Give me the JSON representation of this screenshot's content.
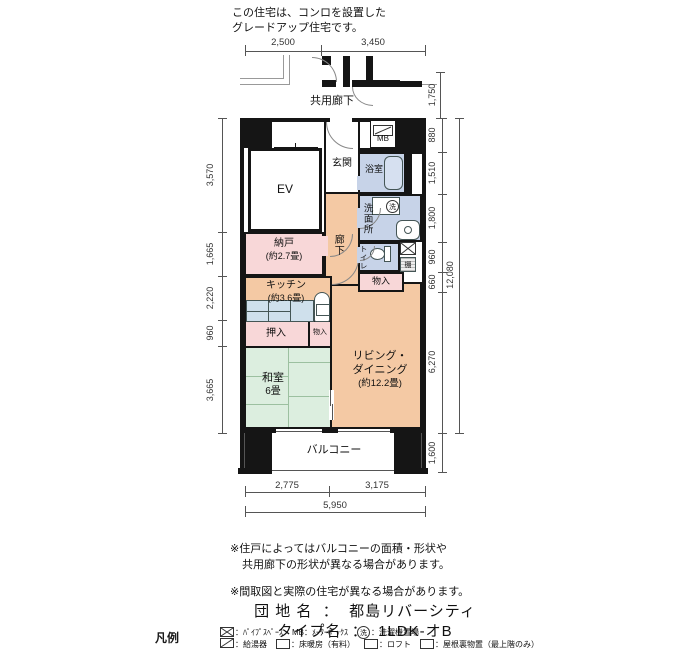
{
  "header_note": {
    "line1": "この住宅は、コンロを設置した",
    "line2": "グレードアップ住宅です。"
  },
  "plan": {
    "corridor_label": "共用廊下",
    "balcony_label": "バルコニー",
    "rooms": {
      "ev": "EV",
      "entrance": "玄関",
      "mb": "MB",
      "bath": "浴室",
      "washroom": "洗面所",
      "hallway": "廊下",
      "storage_room_name": "納戸",
      "storage_room_size": "(約2.7畳)",
      "kitchen_name": "キッチン",
      "kitchen_size": "(約3.6畳)",
      "toilet": "トイレ",
      "shelf": "棚",
      "closet_right": "物入",
      "oshiire": "押入",
      "closet_small": "物入",
      "living_line1": "リビング・",
      "living_line2": "ダイニング",
      "living_line3": "(約12.2畳)",
      "japanese_room_name": "和室",
      "japanese_room_size": "6畳",
      "washer_symbol": "洗"
    }
  },
  "dimensions": {
    "top": [
      "2,500",
      "3,450"
    ],
    "left": [
      "3,570",
      "1,665",
      "2,220",
      "960",
      "3,665"
    ],
    "right_corridor": "1,750",
    "right": [
      "880",
      "1,510",
      "1,800",
      "960",
      "660",
      "6,270"
    ],
    "right_total": "12,080",
    "right_balcony": "1,600",
    "bottom": [
      "2,775",
      "3,175"
    ],
    "bottom_total": "5,950"
  },
  "notes": {
    "balcony_note_line1": "※住戸によってはバルコニーの面積・形状や",
    "balcony_note_line2": "共用廊下の形状が異なる場合があります。",
    "plan_note": "※間取図と実際の住宅が異なる場合があります。"
  },
  "info": {
    "estate_label": "団 地 名",
    "estate_sep": "：",
    "estate_value": "都島リバーシティ",
    "type_label": "タイプ名",
    "type_sep": "：",
    "type_value": "1LDK-オB"
  },
  "legend": {
    "title": "凡例",
    "pipe_space": "：ﾊﾟｲﾌﾟｽﾍﾟｰｽ",
    "mb_label": "MB：ﾒｰﾀｰﾎﾞｯｸｽ",
    "washer_circle": "洗",
    "washer_label": "：洗濯機置場",
    "heater": "：給湯器",
    "floor_heating": "：床暖房（有料）",
    "loft": "：ロフト",
    "attic": "：屋根裏物置（最上階のみ）"
  },
  "palette": {
    "wall": "#151515",
    "room_peach": "#F4C9A4",
    "room_pink": "#F8D7D8",
    "room_blue": "#C7D3E8",
    "room_green": "#DCEEDF",
    "fixture_blue": "#CFE0EC",
    "tatami_line": "#9CC0A0"
  }
}
